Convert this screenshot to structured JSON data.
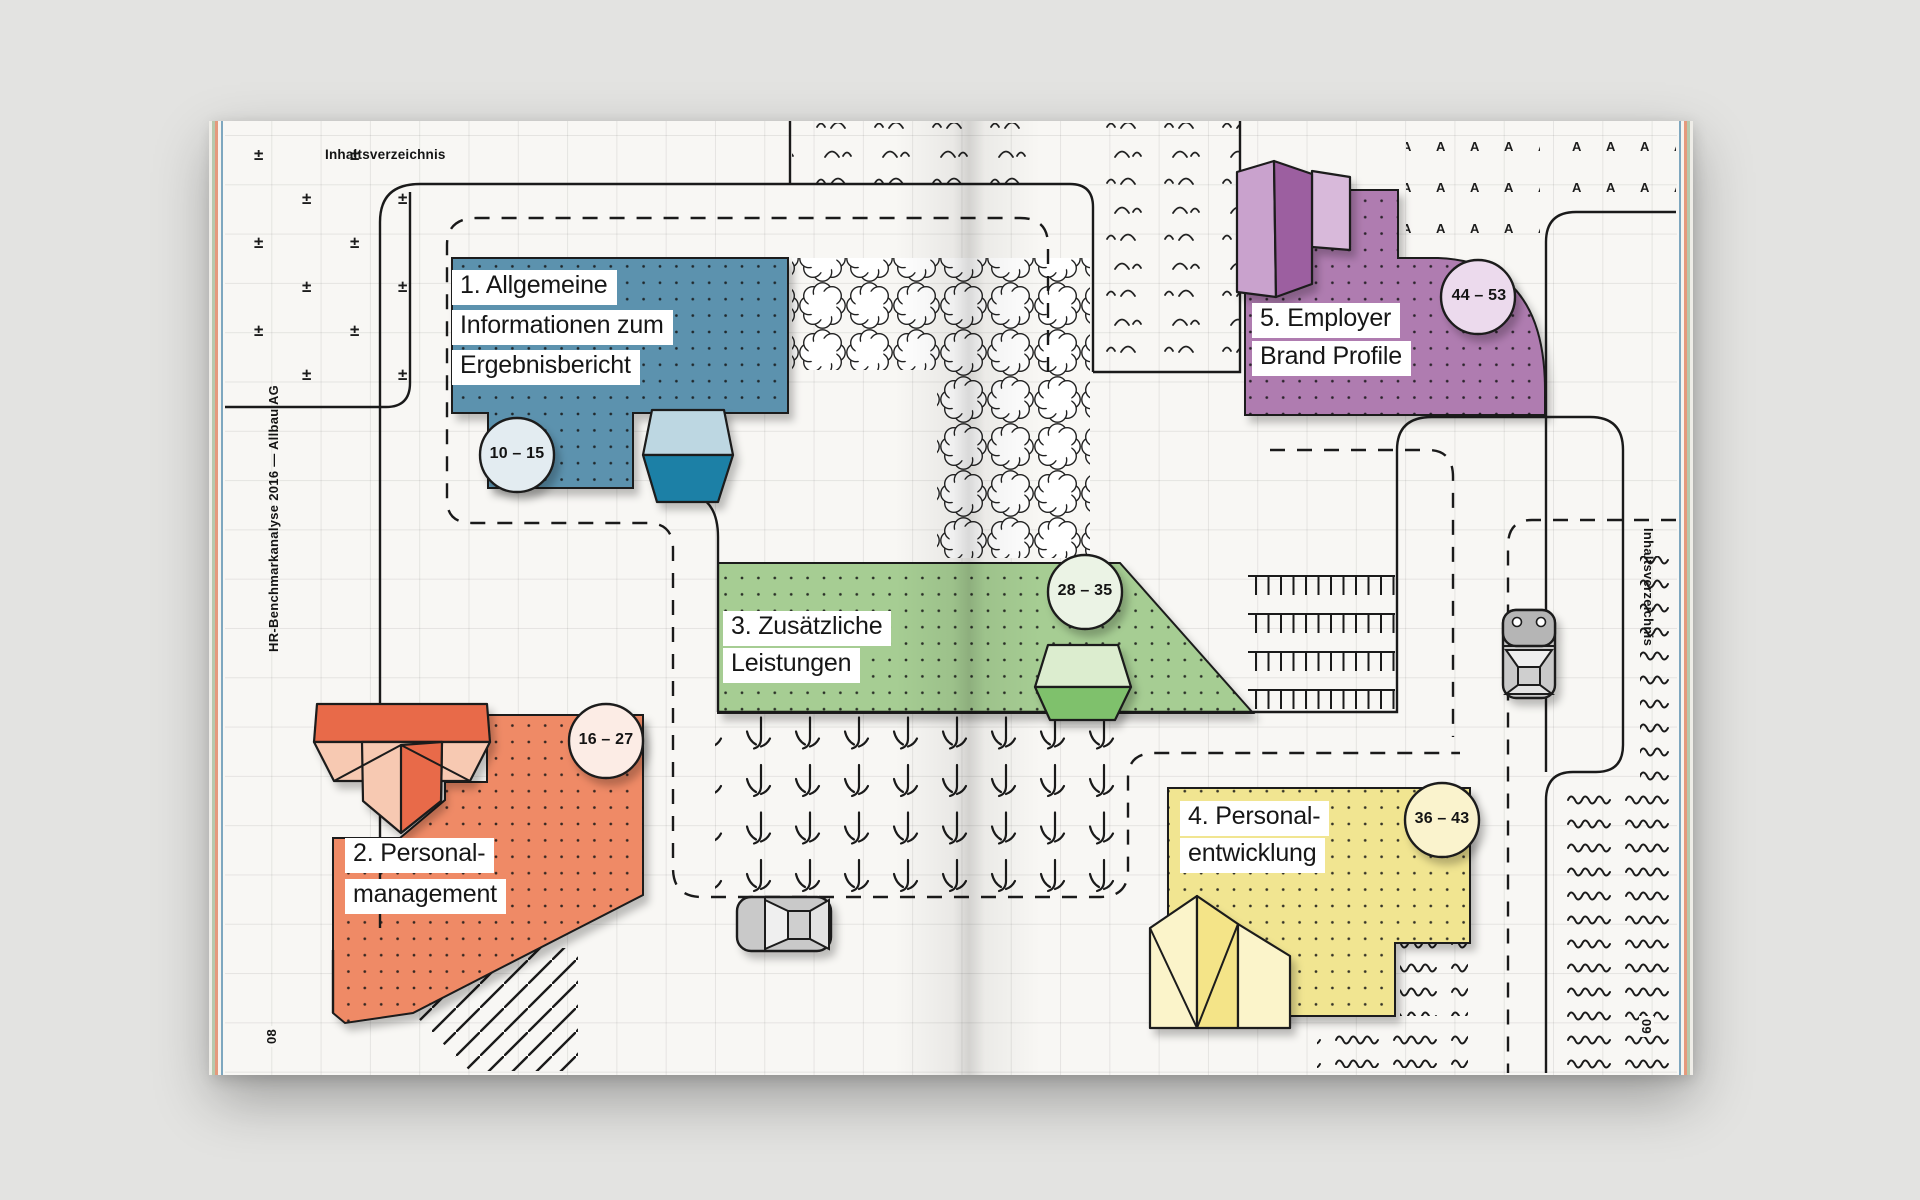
{
  "document": {
    "header": "Inhaltsverzeichnis",
    "sidebar_left": "HR-Benchmarkanalyse 2016  —  Allbau AG",
    "sidebar_right": "Inhaltsverzeichnis",
    "page_number_left": "08",
    "page_number_right": "09"
  },
  "toc_sections": [
    {
      "number": "1",
      "title_lines": [
        "1. Allgemeine",
        "Informationen zum",
        "Ergebnisbericht"
      ],
      "page_range": "10 – 15",
      "area_color": "#5B92AE"
    },
    {
      "number": "2",
      "title_lines": [
        "2. Personal-",
        "management"
      ],
      "page_range": "16 – 27",
      "area_color": "#EF8A66"
    },
    {
      "number": "3",
      "title_lines": [
        "3. Zusätzliche",
        "Leistungen"
      ],
      "page_range": "28 – 35",
      "area_color": "#A6CD93"
    },
    {
      "number": "4",
      "title_lines": [
        "4. Personal-",
        "entwicklung"
      ],
      "page_range": "36 – 43",
      "area_color": "#F1E591"
    },
    {
      "number": "5",
      "title_lines": [
        "5. Employer",
        "Brand Profile"
      ],
      "page_range": "44 – 53",
      "area_color": "#AF7BB0"
    }
  ],
  "map_glyphs": {
    "plus": "±",
    "letter": "A"
  }
}
